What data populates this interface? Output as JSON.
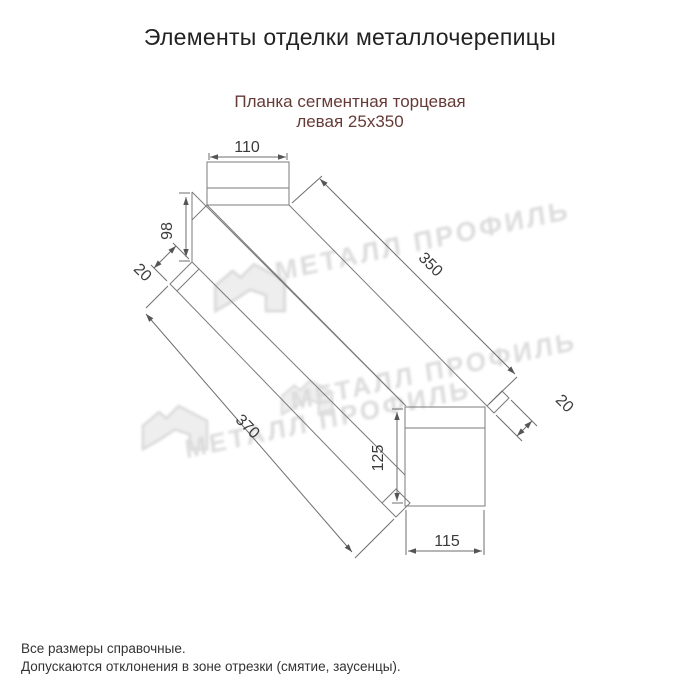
{
  "header": {
    "title": "Элементы отделки металлочерепицы"
  },
  "product": {
    "name_line1": "Планка сегментная торцевая",
    "name_line2": "левая 25х350"
  },
  "diagram": {
    "type": "axonometric technical drawing of left segmental end strip 25x350",
    "dims": {
      "top_flange_width": "110",
      "end_face_height": "98",
      "hem_left": "20",
      "length_right_edge": "350",
      "length_left_edge": "370",
      "hem_right": "20",
      "bottom_end_height": "125",
      "bottom_end_width": "115"
    }
  },
  "watermark": {
    "text": "МЕТАЛЛ ПРОФИЛЬ"
  },
  "notes": {
    "line1": "Все размеры справочные.",
    "line2": "Допускаются отклонения в зоне отрезки (смятие, заусенцы)."
  },
  "colors": {
    "background": "#ffffff",
    "title_text": "#222222",
    "subtitle_text": "#663a36",
    "drawing_line": "#7b7b7b",
    "dimension_text": "#3b3b3b",
    "watermark": "#dcdcdc",
    "notes_text": "#333333"
  }
}
